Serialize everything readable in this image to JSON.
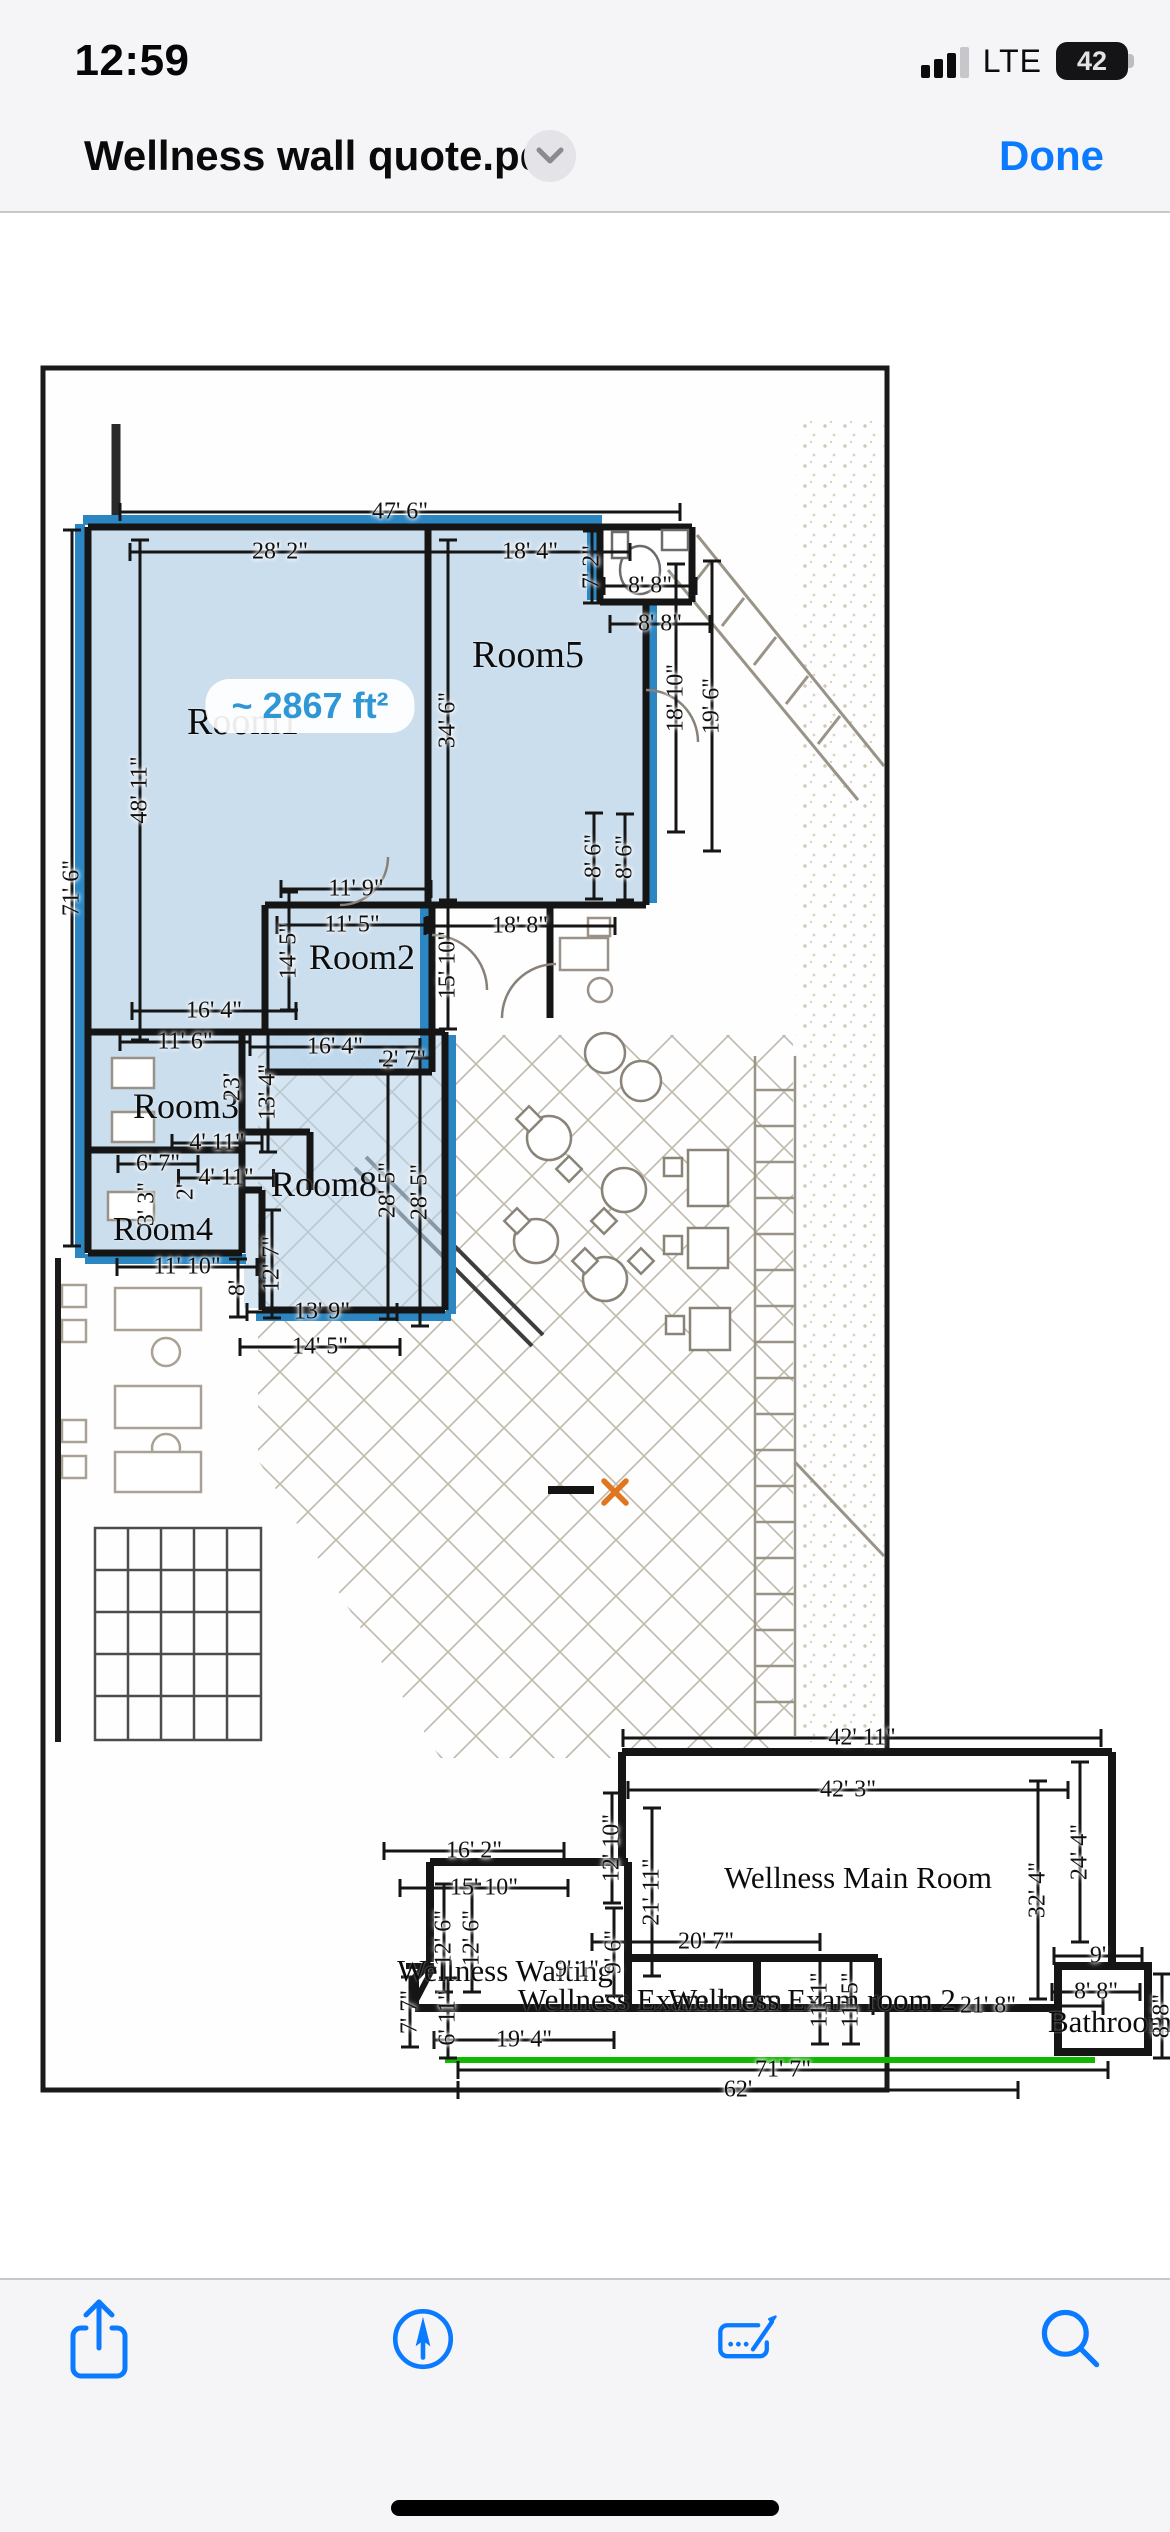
{
  "status_bar": {
    "time": "12:59",
    "network": "LTE",
    "battery_level": "42"
  },
  "nav_bar": {
    "title": "Wellness wall quote.pdf",
    "done_label": "Done"
  },
  "toolbar": {
    "items": [
      "share-icon",
      "markup-compass-icon",
      "form-fill-icon",
      "search-icon"
    ]
  },
  "floorplan": {
    "area_badge": "~ 2867 ft²",
    "colors": {
      "highlight_blue": "#2b86c2",
      "room_fill": "#c7dbeb",
      "green_marker": "#12b800",
      "x_marker": "#e0761f"
    },
    "room_labels": [
      [
        "Room1",
        243,
        722,
        38
      ],
      [
        "Room5",
        528,
        655,
        38
      ],
      [
        "Room2",
        362,
        957,
        36
      ],
      [
        "Room3",
        186,
        1106,
        36
      ],
      [
        "Room8",
        324,
        1184,
        36
      ],
      [
        "Room4",
        163,
        1230,
        34
      ],
      [
        "Wellness Main Room",
        858,
        1878,
        31
      ],
      [
        "Wellness Waiting",
        505,
        1971,
        31
      ],
      [
        "Wellness Exam room",
        650,
        2000,
        31
      ],
      [
        "Wellness Exam room 2",
        812,
        2000,
        31
      ],
      [
        "Bathroom",
        1110,
        2022,
        31
      ]
    ],
    "dimension_labels": [
      [
        "47' 6\"",
        400,
        512,
        0,
        560
      ],
      [
        "28' 2\"",
        280,
        552,
        0,
        300
      ],
      [
        "18' 4\"",
        530,
        552,
        0,
        200
      ],
      [
        "7' 2\"",
        592,
        567,
        -90,
        72
      ],
      [
        "8' 8\"",
        650,
        586,
        0,
        92
      ],
      [
        "8' 8\"",
        660,
        624,
        0,
        100
      ],
      [
        "71' 6\"",
        72,
        888,
        -90,
        716
      ],
      [
        "48' 11\"",
        140,
        790,
        -90,
        500
      ],
      [
        "34' 6\"",
        448,
        720,
        -90,
        360
      ],
      [
        "18' 10\"",
        676,
        698,
        -90,
        268
      ],
      [
        "19' 6\"",
        712,
        706,
        -90,
        290
      ],
      [
        "8' 6\"",
        594,
        856,
        -90,
        86
      ],
      [
        "8' 6\"",
        625,
        857,
        -90,
        86
      ],
      [
        "11' 9\"",
        356,
        889,
        0,
        150
      ],
      [
        "11' 5\"",
        352,
        925,
        0,
        150
      ],
      [
        "18' 8\"",
        520,
        926,
        0,
        190
      ],
      [
        "14' 5\"",
        289,
        951,
        -90,
        118
      ],
      [
        "15' 10\"",
        448,
        965,
        -90,
        128
      ],
      [
        "16' 4\"",
        214,
        1011,
        0,
        164
      ],
      [
        "11' 6\"",
        185,
        1042,
        0,
        130
      ],
      [
        "16' 4\"",
        335,
        1047,
        0,
        170
      ],
      [
        "2' 7\"",
        404,
        1060,
        0,
        0
      ],
      [
        "23'",
        233,
        1087,
        -90,
        0
      ],
      [
        "13' 4\"",
        268,
        1092,
        -90,
        120
      ],
      [
        "4' 11\"",
        217,
        1143,
        0,
        90
      ],
      [
        "6' 7\"",
        158,
        1164,
        0,
        80
      ],
      [
        "4' 11\"",
        226,
        1178,
        0,
        95
      ],
      [
        "3' 3\"",
        147,
        1204,
        -90,
        0
      ],
      [
        "2'",
        186,
        1192,
        -90,
        0
      ],
      [
        "28' 5\"",
        388,
        1190,
        -90,
        258
      ],
      [
        "28' 5\"",
        420,
        1192,
        -90,
        268
      ],
      [
        "11' 10\"",
        187,
        1267,
        0,
        140
      ],
      [
        "12' 7\"",
        272,
        1264,
        -90,
        108
      ],
      [
        "8'",
        238,
        1288,
        -90,
        58
      ],
      [
        "13' 9\"",
        322,
        1312,
        0,
        150
      ],
      [
        "14' 5\"",
        320,
        1347,
        0,
        160
      ],
      [
        "42' 11\"",
        862,
        1738,
        0,
        478
      ],
      [
        "42' 3\"",
        848,
        1790,
        0,
        440
      ],
      [
        "12' 10\"",
        612,
        1848,
        -90,
        110
      ],
      [
        "21' 11\"",
        652,
        1892,
        -90,
        168
      ],
      [
        "16' 2\"",
        474,
        1851,
        0,
        180
      ],
      [
        "15' 10\"",
        484,
        1888,
        0,
        168
      ],
      [
        "12' 6\"",
        444,
        1938,
        -90,
        108
      ],
      [
        "12' 6\"",
        472,
        1938,
        -90,
        108
      ],
      [
        "9' 6\"",
        614,
        1952,
        -90,
        88
      ],
      [
        "20' 7\"",
        706,
        1942,
        0,
        228
      ],
      [
        "9' 1\"",
        577,
        1970,
        0,
        0
      ],
      [
        "11' 1\"",
        820,
        2000,
        -90,
        88
      ],
      [
        "11' 5\"",
        851,
        2000,
        -90,
        88
      ],
      [
        "21' 8\"",
        988,
        2006,
        0,
        230
      ],
      [
        "32' 4\"",
        1038,
        1890,
        -90,
        218
      ],
      [
        "24' 4\"",
        1080,
        1852,
        -90,
        180
      ],
      [
        "9'",
        1098,
        1956,
        0,
        88
      ],
      [
        "8' 8\"",
        1096,
        1992,
        0,
        88
      ],
      [
        "8' 8\"",
        1162,
        2016,
        -90,
        84
      ],
      [
        "7' 7\"",
        410,
        2012,
        -90,
        70
      ],
      [
        "6' 11\"",
        448,
        2018,
        -90,
        80
      ],
      [
        "19' 4\"",
        524,
        2040,
        0,
        180
      ],
      [
        "71' 7\"",
        783,
        2070,
        0,
        650
      ],
      [
        "62'",
        738,
        2090,
        0,
        560
      ]
    ]
  }
}
